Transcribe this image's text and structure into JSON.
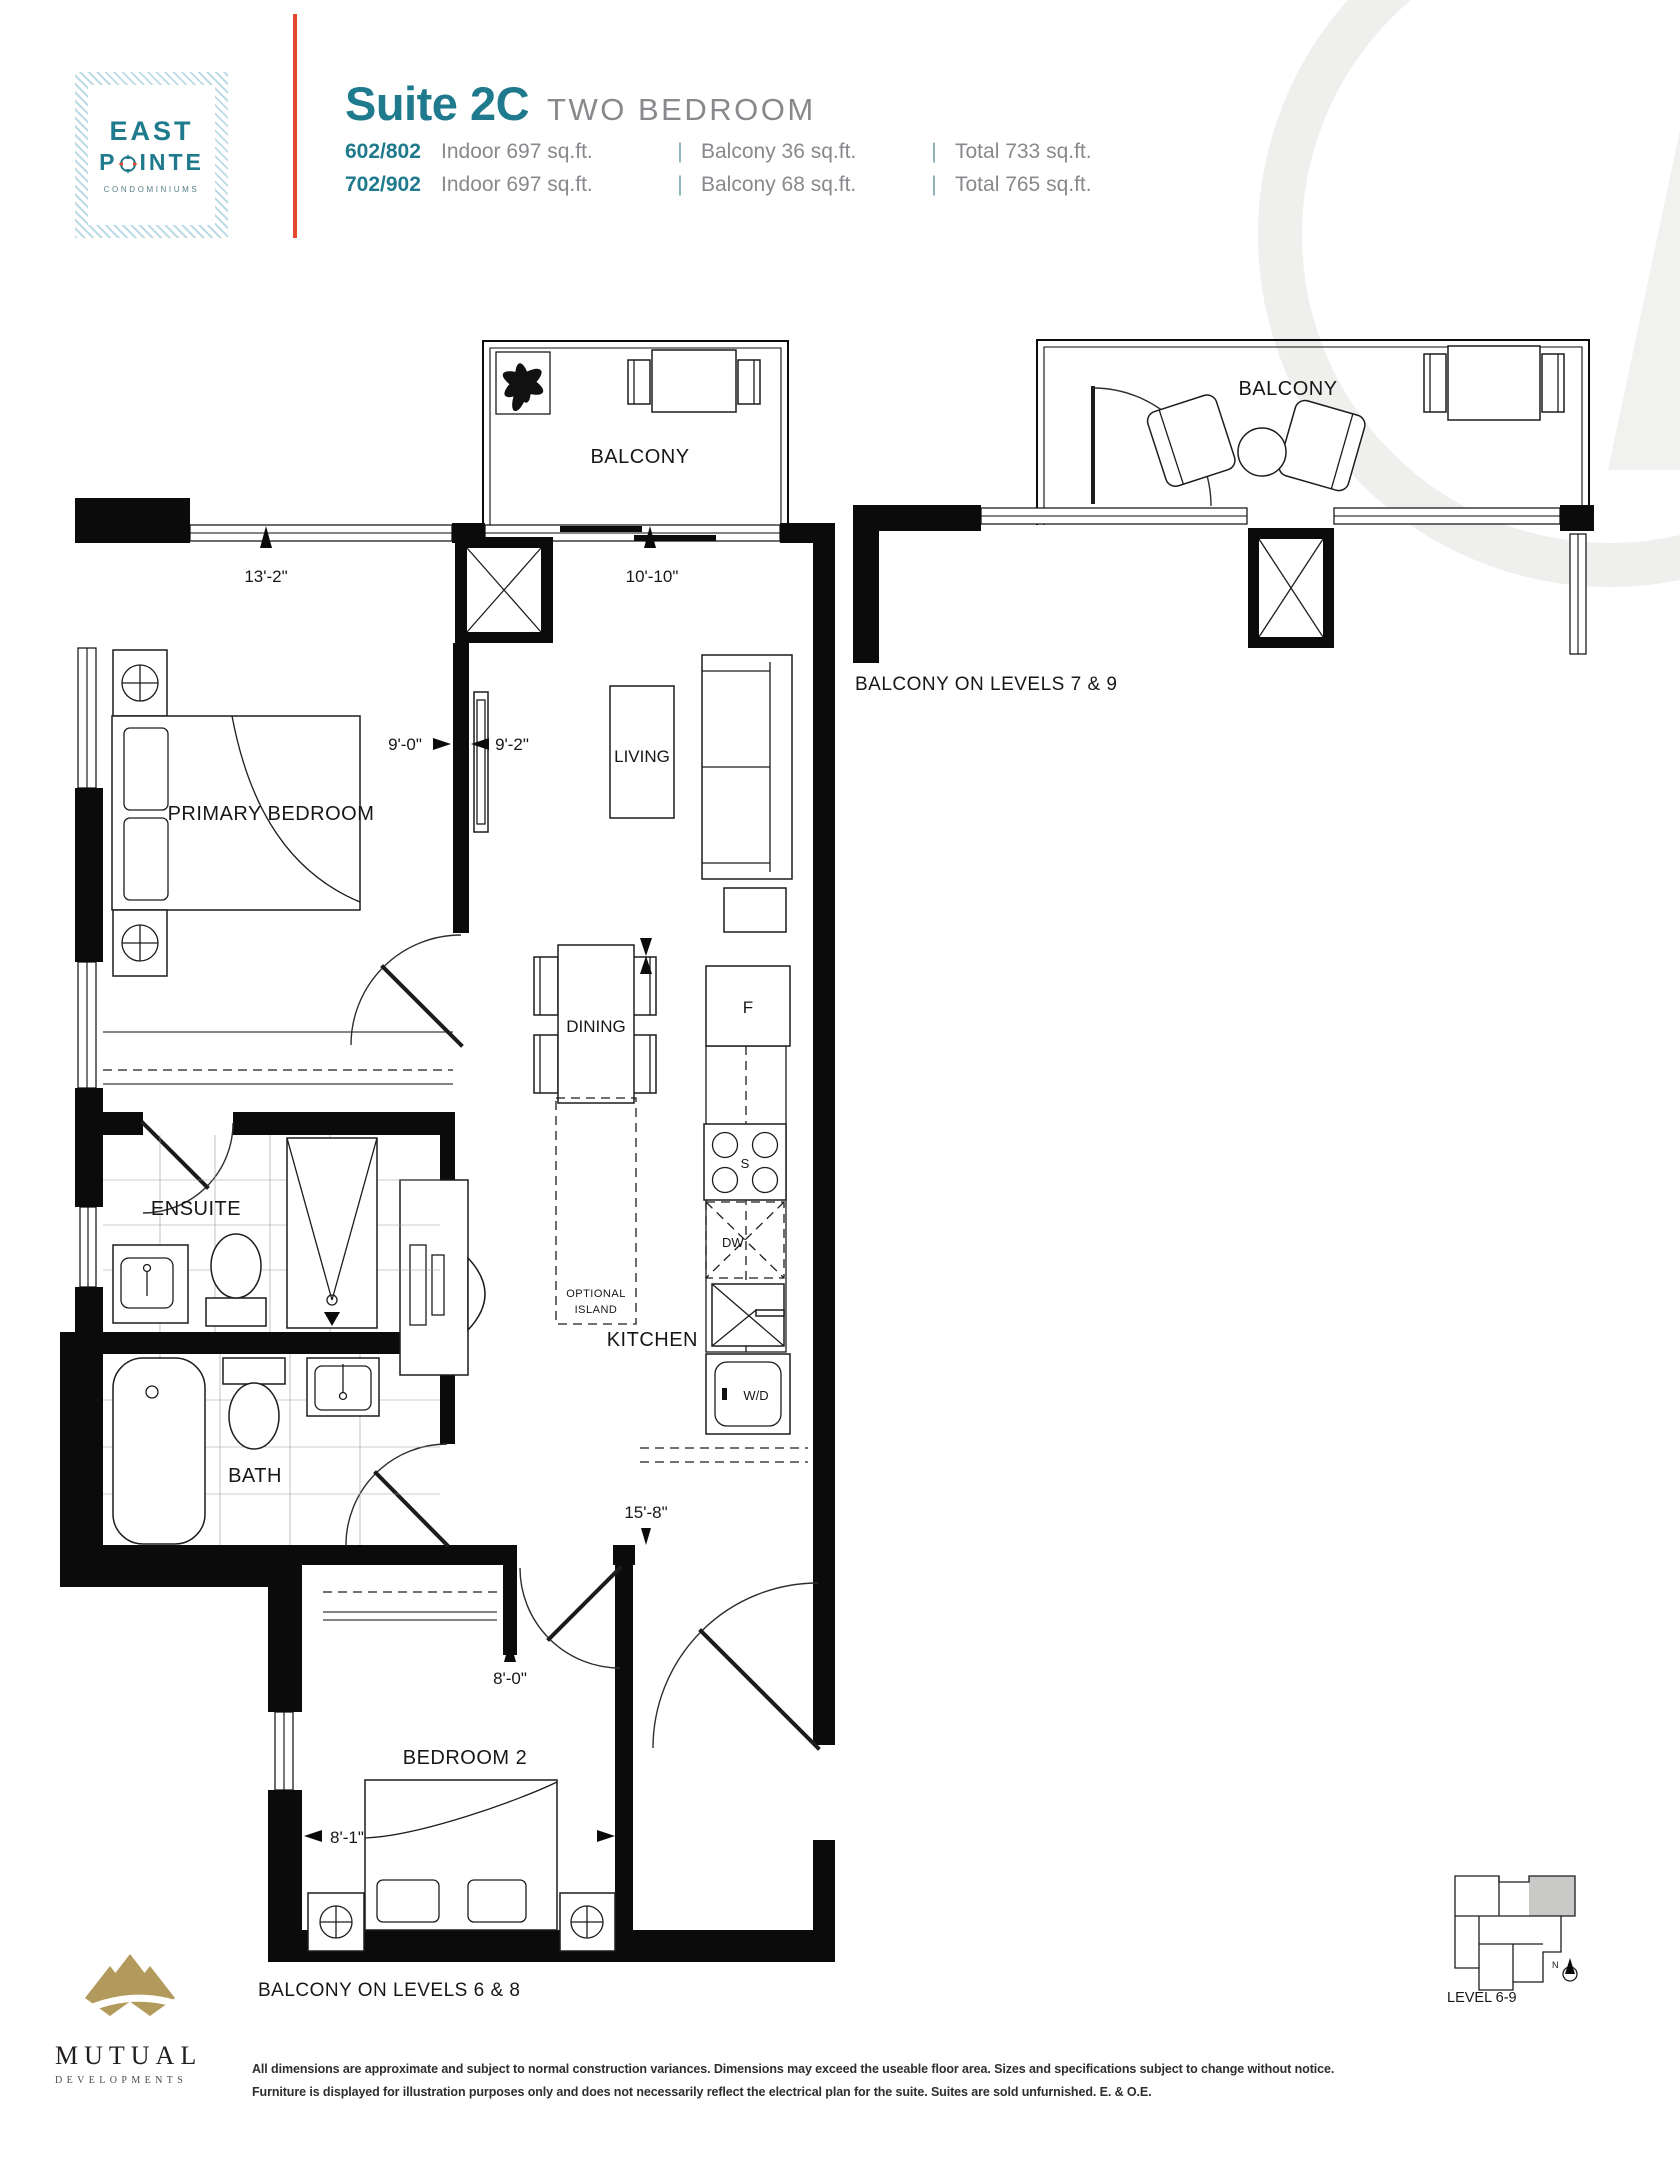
{
  "brand": {
    "line1": "EAST",
    "line2_pre": "P",
    "line2_post": "INTE",
    "tagline": "CONDOMINIUMS"
  },
  "header": {
    "suite": "Suite 2C",
    "type": "TWO BEDROOM",
    "sep": "|",
    "units": [
      {
        "no": "602/802",
        "indoor": "Indoor 697 sq.ft.",
        "balcony": "Balcony 36 sq.ft.",
        "total": "Total 733 sq.ft."
      },
      {
        "no": "702/902",
        "indoor": "Indoor 697 sq.ft.",
        "balcony": "Balcony 68 sq.ft.",
        "total": "Total 765 sq.ft."
      }
    ]
  },
  "plan": {
    "labels": {
      "balcony": "BALCONY",
      "primary_bedroom": "PRIMARY BEDROOM",
      "living": "LIVING",
      "dining": "DINING",
      "kitchen": "KITCHEN",
      "ensuite": "ENSUITE",
      "bath": "BATH",
      "bedroom2": "BEDROOM 2",
      "optional_island_1": "OPTIONAL",
      "optional_island_2": "ISLAND",
      "fridge": "F",
      "stove": "S",
      "dishwasher": "DW",
      "washer_dryer": "W/D"
    },
    "dims": {
      "primary_w": "13'-2\"",
      "living_w": "10'-10\"",
      "primary_d": "9'-0\"",
      "living_d": "9'-2\"",
      "hall_l": "15'-8\"",
      "bed2_w": "8'-0\"",
      "bed2_d": "8'-1\""
    },
    "notes": {
      "main": "BALCONY ON LEVELS 6 & 8",
      "alt": "BALCONY ON LEVELS 7 & 9",
      "alt_balcony": "BALCONY"
    }
  },
  "keyplan": {
    "label": "LEVEL 6-9",
    "north": "N"
  },
  "footer": {
    "developer_name": "MUTUAL",
    "developer_sub": "DEVELOPMENTS",
    "disclaimer1": "All dimensions are approximate and subject to normal construction variances. Dimensions may exceed the useable floor area. Sizes and specifications subject to change without notice.",
    "disclaimer2": "Furniture is displayed for illustration purposes only and does not necessarily reflect the electrical plan for the suite. Suites are sold unfurnished. E. & O.E."
  }
}
